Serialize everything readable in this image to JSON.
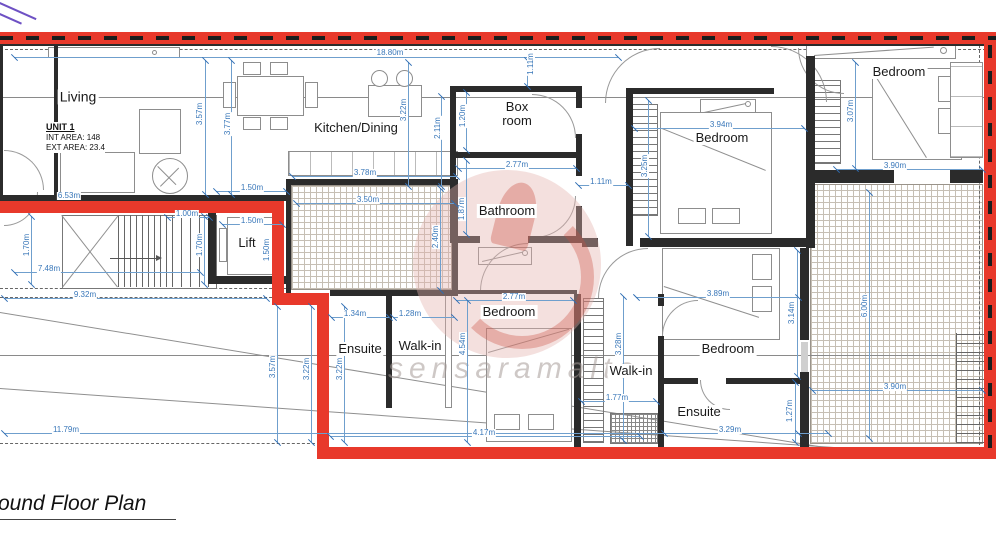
{
  "title": "ound Floor Plan",
  "unit_info": {
    "name": "UNIT 1",
    "int_area": "INT AREA: 148",
    "ext_area": "EXT AREA: 23.4"
  },
  "watermark": "sensaramalta",
  "colors": {
    "boundary_red": "#e8392b",
    "dimension_blue": "#3977b9",
    "wall_dark": "#2b2b2b"
  },
  "rooms": [
    {
      "label": "Living",
      "x": 78,
      "y": 97,
      "fs": 14
    },
    {
      "label": "Kitchen/Dining",
      "x": 356,
      "y": 128,
      "fs": 13
    },
    {
      "label": "Box\nroom",
      "x": 517,
      "y": 114,
      "fs": 13
    },
    {
      "label": "Bathroom",
      "x": 507,
      "y": 211,
      "fs": 13
    },
    {
      "label": "Bedroom",
      "x": 722,
      "y": 138,
      "fs": 13
    },
    {
      "label": "Bedroom",
      "x": 899,
      "y": 72,
      "fs": 13
    },
    {
      "label": "Bedroom",
      "x": 509,
      "y": 312,
      "fs": 13
    },
    {
      "label": "Bedroom",
      "x": 728,
      "y": 349,
      "fs": 13
    },
    {
      "label": "Ensuite",
      "x": 360,
      "y": 349,
      "fs": 13
    },
    {
      "label": "Walk-in",
      "x": 420,
      "y": 346,
      "fs": 13
    },
    {
      "label": "Walk-in",
      "x": 631,
      "y": 371,
      "fs": 13
    },
    {
      "label": "Ensuite",
      "x": 699,
      "y": 412,
      "fs": 13
    },
    {
      "label": "Lift",
      "x": 247,
      "y": 243,
      "fs": 13
    }
  ],
  "dims": [
    {
      "t": "18.80m",
      "x": 390,
      "y": 53,
      "o": "h",
      "l": [
        14,
        618,
        57
      ]
    },
    {
      "t": "1.11m",
      "x": 531,
      "y": 64,
      "o": "v",
      "l": [
        60,
        86,
        527
      ]
    },
    {
      "t": "3.57m",
      "x": 200,
      "y": 114,
      "o": "v",
      "l": [
        60,
        194,
        205
      ]
    },
    {
      "t": "3.77m",
      "x": 228,
      "y": 124,
      "o": "v",
      "l": [
        60,
        194,
        231
      ]
    },
    {
      "t": "3.22m",
      "x": 404,
      "y": 110,
      "o": "v",
      "l": [
        62,
        186,
        408
      ]
    },
    {
      "t": "2.11m",
      "x": 438,
      "y": 128,
      "o": "v",
      "l": [
        96,
        186,
        441
      ]
    },
    {
      "t": "1.20m",
      "x": 463,
      "y": 116,
      "o": "v",
      "l": [
        92,
        150,
        466
      ]
    },
    {
      "t": "2.77m",
      "x": 517,
      "y": 165,
      "o": "h",
      "l": [
        458,
        576,
        168
      ]
    },
    {
      "t": "1.11m",
      "x": 601,
      "y": 182,
      "o": "h",
      "l": [
        578,
        628,
        185
      ]
    },
    {
      "t": "3.94m",
      "x": 721,
      "y": 125,
      "o": "h",
      "l": [
        634,
        804,
        128
      ]
    },
    {
      "t": "3.25m",
      "x": 645,
      "y": 166,
      "o": "v",
      "l": [
        100,
        236,
        648
      ]
    },
    {
      "t": "3.07m",
      "x": 851,
      "y": 111,
      "o": "v",
      "l": [
        62,
        168,
        855
      ]
    },
    {
      "t": "3.90m",
      "x": 895,
      "y": 166,
      "o": "h",
      "l": [
        836,
        982,
        169
      ]
    },
    {
      "t": "1.50m",
      "x": 252,
      "y": 188,
      "o": "h",
      "l": [
        216,
        286,
        191
      ]
    },
    {
      "t": "1.00m",
      "x": 187,
      "y": 214,
      "o": "h",
      "l": [
        167,
        209,
        217
      ]
    },
    {
      "t": "1.50m",
      "x": 252,
      "y": 221,
      "o": "h",
      "l": [
        222,
        282,
        224
      ]
    },
    {
      "t": "1.50m",
      "x": 267,
      "y": 250,
      "o": "v",
      "l": null
    },
    {
      "t": "1.70m",
      "x": 27,
      "y": 245,
      "o": "v",
      "l": [
        216,
        284,
        31
      ]
    },
    {
      "t": "1.70m",
      "x": 200,
      "y": 245,
      "o": "v",
      "l": [
        216,
        284,
        204
      ]
    },
    {
      "t": "7.48m",
      "x": 49,
      "y": 269,
      "o": "h",
      "l": [
        14,
        200,
        272
      ]
    },
    {
      "t": "9.32m",
      "x": 85,
      "y": 295,
      "o": "h",
      "l": [
        4,
        266,
        298
      ]
    },
    {
      "t": "6.53m",
      "x": 69,
      "y": 196,
      "o": "h",
      "l": null
    },
    {
      "t": "3.78m",
      "x": 365,
      "y": 173,
      "o": "h",
      "l": [
        292,
        456,
        176
      ]
    },
    {
      "t": "3.50m",
      "x": 368,
      "y": 200,
      "o": "h",
      "l": [
        296,
        454,
        203
      ]
    },
    {
      "t": "1.87m",
      "x": 462,
      "y": 209,
      "o": "v",
      "l": [
        160,
        234,
        466
      ]
    },
    {
      "t": "2.40m",
      "x": 436,
      "y": 237,
      "o": "v",
      "l": [
        188,
        290,
        440
      ]
    },
    {
      "t": "1.34m",
      "x": 355,
      "y": 314,
      "o": "h",
      "l": [
        331,
        389,
        317
      ]
    },
    {
      "t": "1.28m",
      "x": 410,
      "y": 314,
      "o": "h",
      "l": [
        393,
        454,
        317
      ]
    },
    {
      "t": "3.57m",
      "x": 273,
      "y": 367,
      "o": "v",
      "l": [
        306,
        442,
        277
      ]
    },
    {
      "t": "3.22m",
      "x": 307,
      "y": 369,
      "o": "v",
      "l": [
        306,
        442,
        311
      ]
    },
    {
      "t": "3.22m",
      "x": 340,
      "y": 369,
      "o": "v",
      "l": [
        306,
        442,
        344
      ]
    },
    {
      "t": "4.54m",
      "x": 463,
      "y": 344,
      "o": "v",
      "l": [
        300,
        442,
        467
      ]
    },
    {
      "t": "4.17m",
      "x": 484,
      "y": 433,
      "o": "h",
      "l": [
        330,
        640,
        436
      ]
    },
    {
      "t": "2.77m",
      "x": 514,
      "y": 297,
      "o": "h",
      "l": [
        456,
        573,
        300
      ]
    },
    {
      "t": "3.28m",
      "x": 619,
      "y": 344,
      "o": "v",
      "l": [
        296,
        440,
        623
      ]
    },
    {
      "t": "3.89m",
      "x": 718,
      "y": 294,
      "o": "h",
      "l": [
        636,
        798,
        297
      ]
    },
    {
      "t": "3.14m",
      "x": 792,
      "y": 313,
      "o": "v",
      "l": [
        250,
        376,
        797
      ]
    },
    {
      "t": "1.77m",
      "x": 617,
      "y": 398,
      "o": "h",
      "l": [
        581,
        656,
        401
      ]
    },
    {
      "t": "1.27m",
      "x": 790,
      "y": 411,
      "o": "v",
      "l": [
        382,
        442,
        795
      ]
    },
    {
      "t": "3.29m",
      "x": 730,
      "y": 430,
      "o": "h",
      "l": [
        664,
        798,
        433
      ]
    },
    {
      "t": "6.00m",
      "x": 865,
      "y": 306,
      "o": "v",
      "l": [
        192,
        438,
        869
      ]
    },
    {
      "t": "3.90m",
      "x": 895,
      "y": 387,
      "o": "h",
      "l": [
        812,
        982,
        390
      ]
    },
    {
      "t": "11.79m",
      "x": 66,
      "y": 430,
      "o": "h",
      "l": [
        4,
        828,
        433
      ]
    }
  ]
}
